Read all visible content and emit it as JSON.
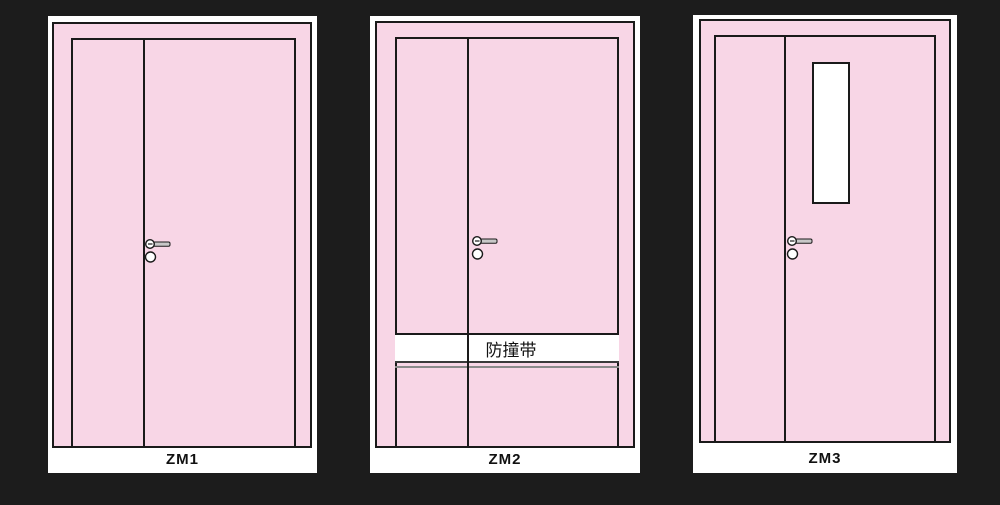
{
  "colors": {
    "background": "#1c1c1c",
    "card": "#ffffff",
    "door_pink": "#f8d6e6",
    "outline_black": "#1a1a1a",
    "handle_gray": "#c8c8c8",
    "strip_shadow_gray": "#8a8a8a"
  },
  "panels": [
    {
      "label": "ZM1"
    },
    {
      "label": "ZM2",
      "strip_label": "防撞带"
    },
    {
      "label": "ZM3"
    }
  ]
}
